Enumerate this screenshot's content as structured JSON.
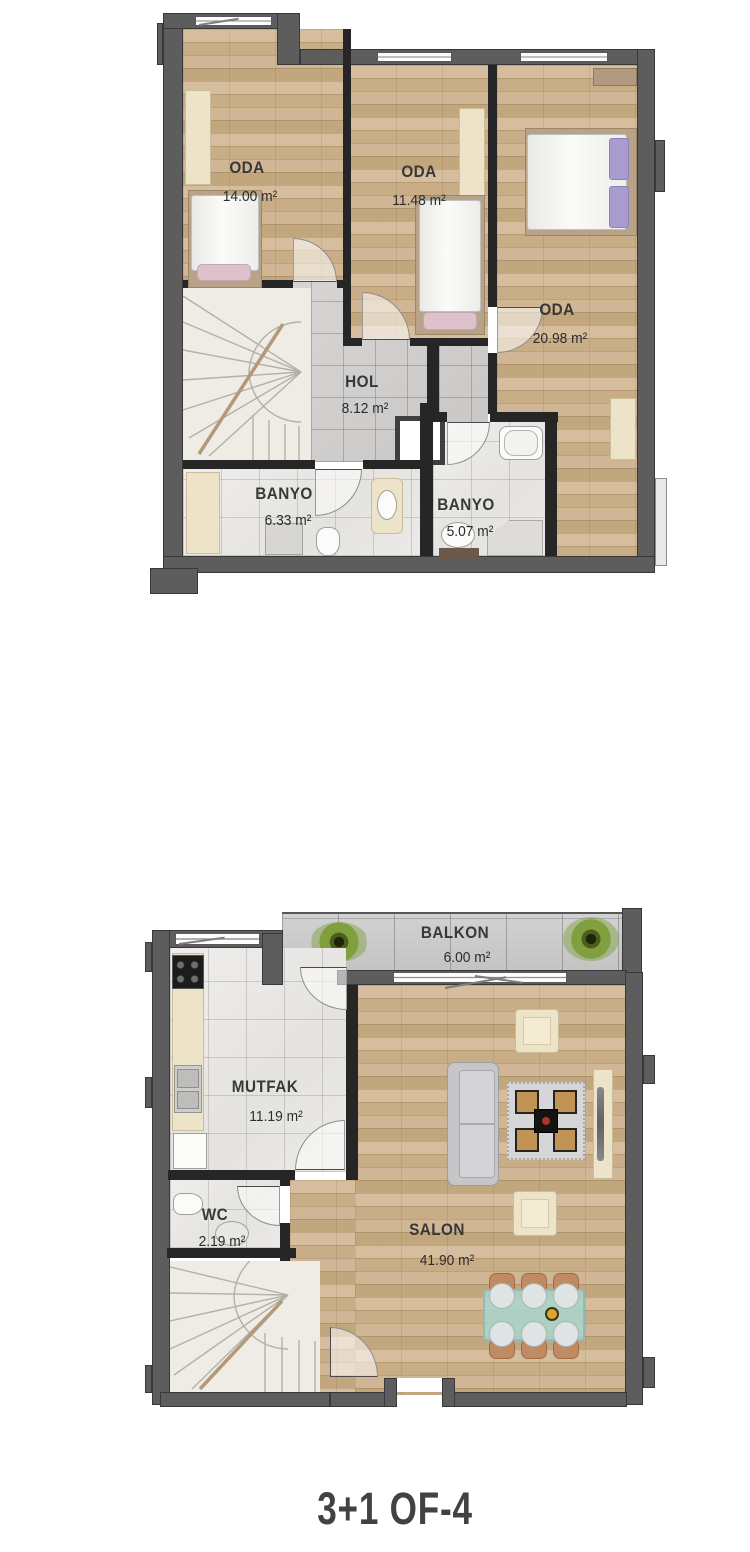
{
  "title": "3+1 OF-4",
  "upper": {
    "oda1": {
      "label": "ODA",
      "area": "14.00 m²"
    },
    "oda2": {
      "label": "ODA",
      "area": "11.48 m²"
    },
    "oda3": {
      "label": "ODA",
      "area": "20.98 m²"
    },
    "hol": {
      "label": "HOL",
      "area": "8.12 m²"
    },
    "banyo1": {
      "label": "BANYO",
      "area": "6.33 m²"
    },
    "banyo2": {
      "label": "BANYO",
      "area": "5.07 m²"
    }
  },
  "lower": {
    "balkon": {
      "label": "BALKON",
      "area": "6.00 m²"
    },
    "mutfak": {
      "label": "MUTFAK",
      "area": "11.19 m²"
    },
    "wc": {
      "label": "WC",
      "area": "2.19 m²"
    },
    "salon": {
      "label": "SALON",
      "area": "41.90 m²"
    }
  },
  "colors": {
    "outer_wall": "#5d5d5d",
    "partition_wall": "#262626",
    "wood_floor": "#cdb292",
    "white_tile": "#eceae7",
    "hall_tile": "#d2d0ce",
    "balcony_tile": "#c7c7c7",
    "stair": "#efece5",
    "furniture_cream": "#ece3c8",
    "plant_green": "#7c9d37",
    "label_text": "#383838"
  }
}
